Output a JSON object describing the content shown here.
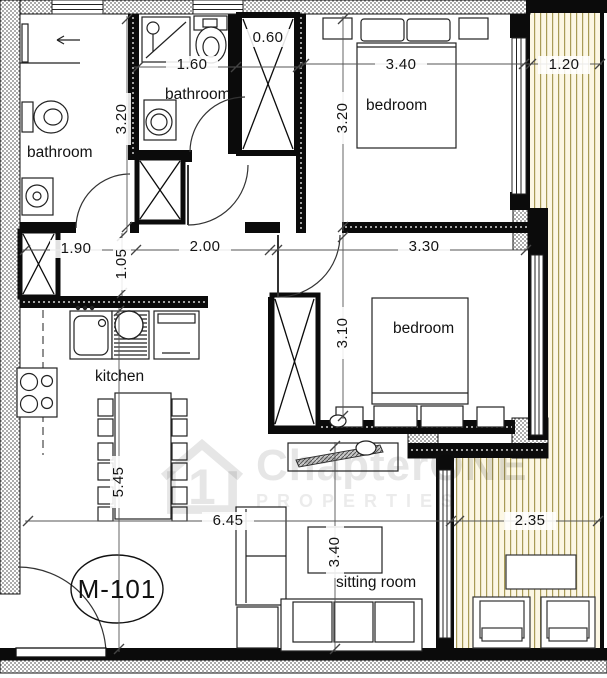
{
  "unit_label": "M-101",
  "watermark": {
    "logo_digit": "1",
    "brand_main": "Chapter",
    "brand_accent": "ONE",
    "subtitle": "PROPERTIES"
  },
  "rooms": {
    "bathroom1": "bathroom",
    "bathroom2": "bathroom",
    "bedroom1": "bedroom",
    "bedroom2": "bedroom",
    "kitchen": "kitchen",
    "sitting_room": "sitting room"
  },
  "dimensions": {
    "shaft_width": "0.60",
    "bathroom2_width": "1.60",
    "bedroom1_width": "3.40",
    "balcony_top_width": "1.20",
    "bathroom1_height": "3.20",
    "bedroom1_height": "3.20",
    "hall_left_width": "1.90",
    "hall_height": "1.05",
    "hall_mid_width": "2.00",
    "bedroom2_width": "3.30",
    "bedroom2_height": "3.10",
    "living_height": "5.45",
    "living_width": "6.45",
    "sitting_height": "3.40",
    "balcony_bottom_width": "2.35"
  }
}
